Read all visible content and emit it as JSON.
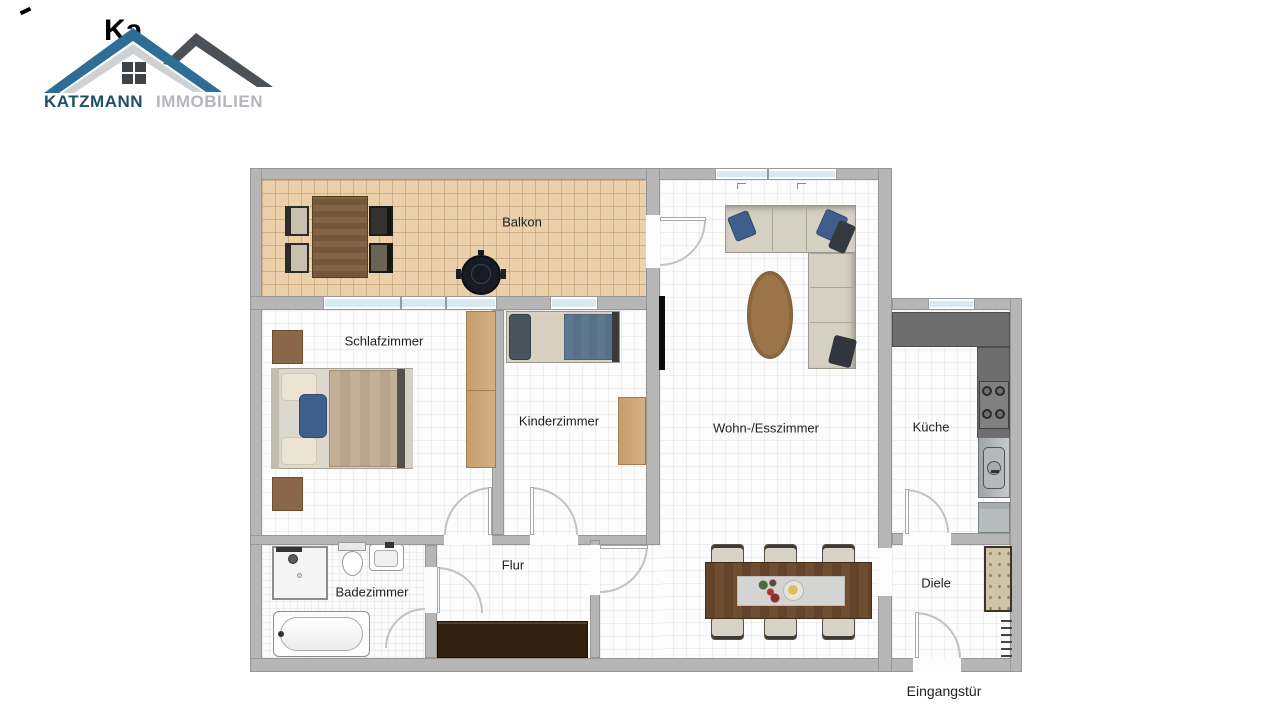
{
  "logo": {
    "brand": "KATZMANN",
    "suffix": "IMMOBILIEN",
    "watermark_fragment": "Ka",
    "colors": {
      "brand_text": "#1b5068",
      "suffix_text": "#b3b6ba",
      "roof_blue": "#2e6d95",
      "roof_dark": "#4b5156",
      "roof_silver": "#ced2d5",
      "window_dark": "#3e4348"
    }
  },
  "floorplan": {
    "rooms": [
      {
        "id": "balkon",
        "label": "Balkon"
      },
      {
        "id": "schlafzimmer",
        "label": "Schlafzimmer"
      },
      {
        "id": "kinderzimmer",
        "label": "Kinderzimmer"
      },
      {
        "id": "wohn-esszimmer",
        "label": "Wohn-/Esszimmer"
      },
      {
        "id": "kueche",
        "label": "Küche"
      },
      {
        "id": "badezimmer",
        "label": "Badezimmer"
      },
      {
        "id": "flur",
        "label": "Flur"
      },
      {
        "id": "diele",
        "label": "Diele"
      }
    ],
    "entrance_label": "Eingangstür",
    "colors": {
      "wall": "#b6b6b6",
      "wall_outline": "#969696",
      "floor": "#fcfcfc",
      "balcony_floor": "#ecd0ab",
      "window_glass": "#d9e9f1",
      "kitchen_counter": "#6e6e6e",
      "wood_dark": "#6b4a2e",
      "wood_light": "#cfa877",
      "sofa_beige": "#d6d0c2",
      "pillow_blue": "#3f5e8c",
      "hall_sideboard": "#33200f",
      "rug_brown": "#9c7449"
    }
  }
}
